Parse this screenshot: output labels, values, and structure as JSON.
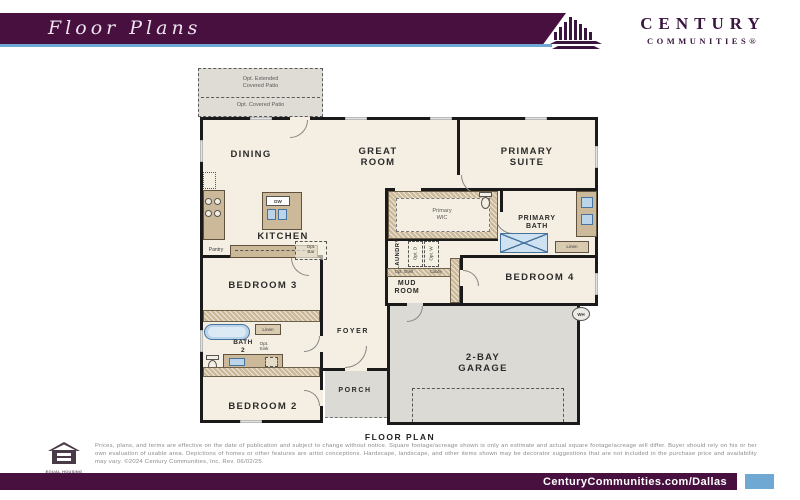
{
  "header": {
    "page_title": "Floor Plans",
    "brand_name": "CENTURY",
    "brand_sub": "COMMUNITIES®"
  },
  "plan": {
    "patio": {
      "opt_extended": "Opt. Extended\nCovered Patio",
      "opt_covered": "Opt. Covered Patio"
    },
    "rooms": {
      "dining": "DINING",
      "great_room": "GREAT\nROOM",
      "primary_suite": "PRIMARY\nSUITE",
      "kitchen": "KITCHEN",
      "bedroom3": "BEDROOM 3",
      "bedroom2": "BEDROOM 2",
      "bedroom4": "BEDROOM 4",
      "bath2": "BATH\n2",
      "foyer": "FOYER",
      "porch": "PORCH",
      "mud_room": "MUD\nROOM",
      "laundry": "LAUNDRY",
      "primary_wic": "Primary\nWIC",
      "primary_bath": "PRIMARY\nBATH",
      "garage": "2-BAY\nGARAGE"
    },
    "small_labels": {
      "pantry": "Pantry",
      "opt_bar": "Opt.\nBar",
      "opt_d": "Opt. D",
      "opt_w": "Opt. W",
      "opt_shelf": "Opt. Shelf",
      "cubby": "Cubby",
      "linen_primary": "Linen",
      "linen_bath2": "Linen",
      "opt_sink": "Opt.\nSink",
      "dw": "DW",
      "wh": "WH"
    },
    "caption": "FLOOR PLAN"
  },
  "footer": {
    "equal_housing": "EQUAL HOUSING\nOPPORTUNITY",
    "disclaimer": "Prices, plans, and terms are effective on the date of publication and subject to change without notice. Square footage/acreage shown is only an estimate and actual square footage/acreage will differ. Buyer should rely on his or her own evaluation of usable area. Depictions of homes or other features are artist conceptions. Hardscape, landscape, and other items shown may be decorator suggestions that are not included in the purchase price and availability may vary. ©2024 Century Communities, Inc. Rev. 06/02/25.",
    "website": "CenturyCommunities.com/Dallas"
  },
  "colors": {
    "brand_purple": "#47103f",
    "accent_blue": "#6fa8d2",
    "plan_cream": "#f4efe2",
    "counter_tan": "#cbb999",
    "fixture_blue": "#bcd4ea"
  }
}
